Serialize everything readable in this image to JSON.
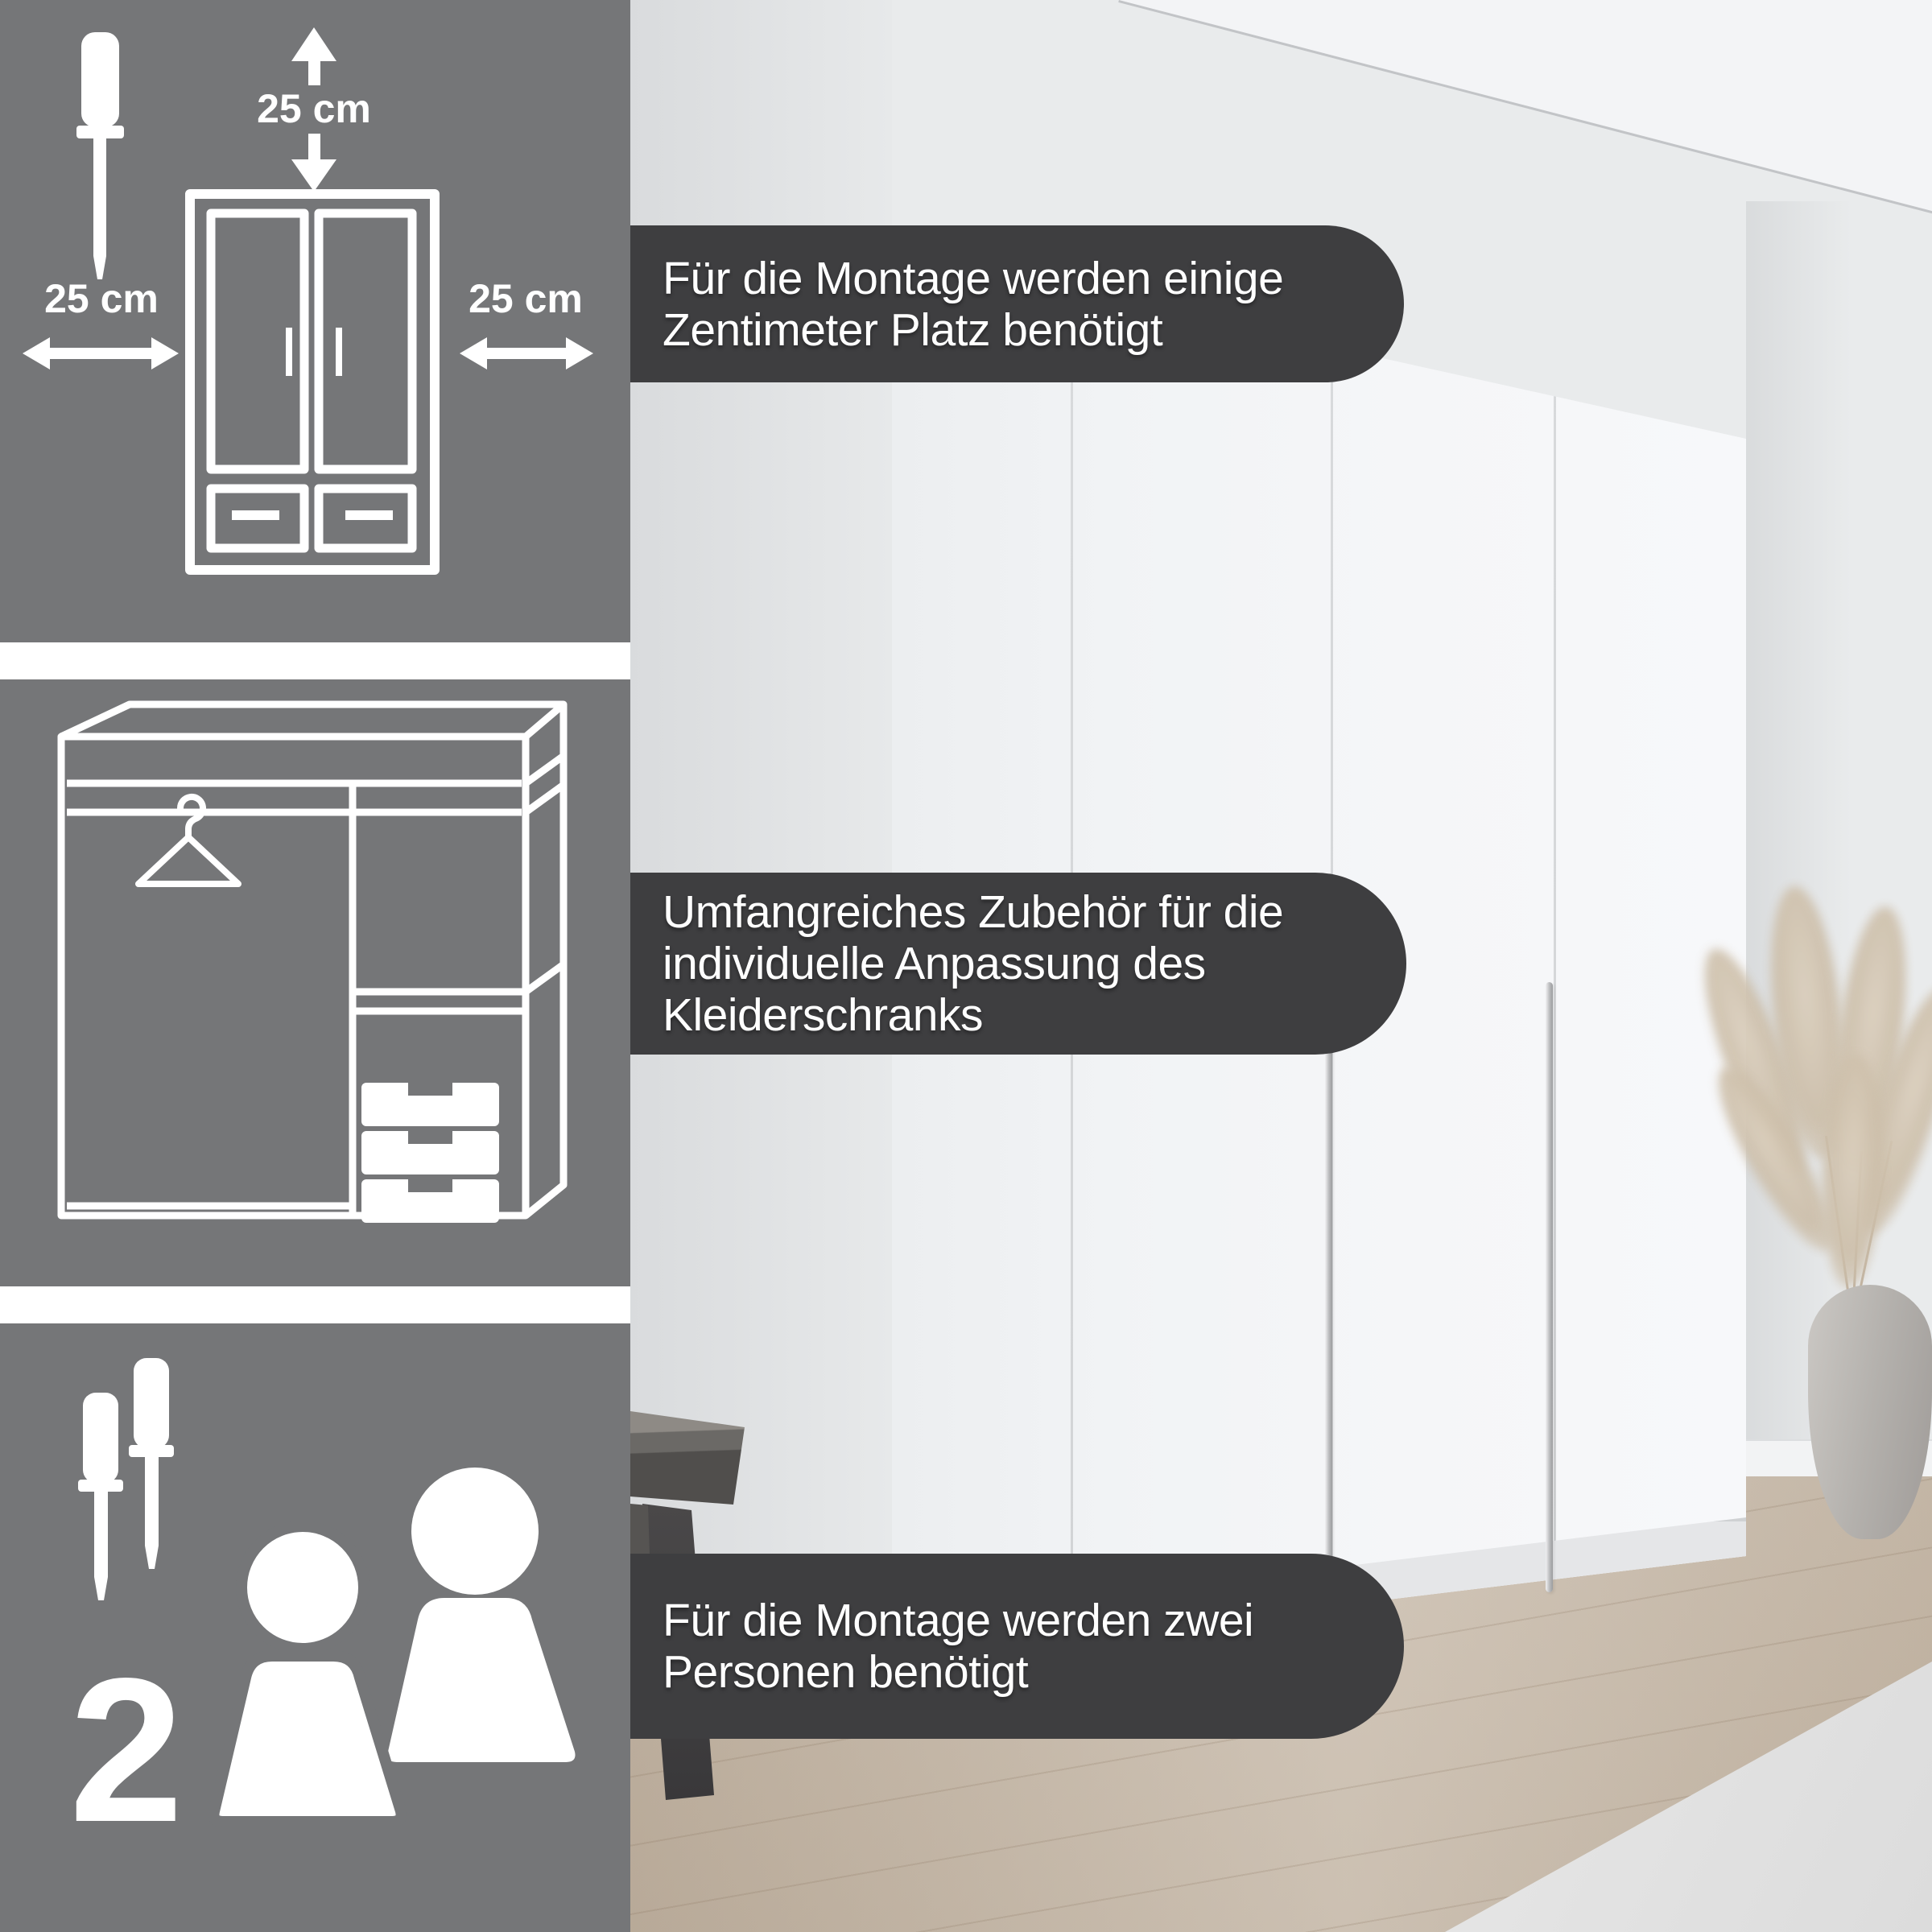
{
  "clearance_panel": {
    "top_label": "25 cm",
    "left_label": "25 cm",
    "right_label": "25 cm"
  },
  "assembly_panel": {
    "person_count": "2"
  },
  "callouts": [
    {
      "lines": [
        "Für die Montage werden einige",
        "Zentimeter Platz benötigt"
      ]
    },
    {
      "lines": [
        "Umfangreiches Zubehör für die",
        "individuelle Anpassung des",
        "Kleiderschranks"
      ]
    },
    {
      "lines": [
        "Für die Montage werden zwei",
        "Personen benötigt"
      ]
    }
  ],
  "icons": {
    "clearance_panel": [
      "screwdriver-icon",
      "arrow-up-icon",
      "arrow-down-icon",
      "arrow-left-right-icon",
      "wardrobe-front-icon"
    ],
    "interior_panel": [
      "wardrobe-interior-icon",
      "hanger-icon",
      "drawers-icon"
    ],
    "assembly_panel": [
      "screwdriver-icon",
      "screwdriver-icon",
      "two-persons-icon"
    ]
  },
  "colors": {
    "panel_bg": "#757678",
    "callout_bg": "#3e3e40",
    "text_light": "#ffffff",
    "wall": "#e9ebec",
    "floor_wood": "#cabdad",
    "handle_silver": "#babbbd"
  }
}
